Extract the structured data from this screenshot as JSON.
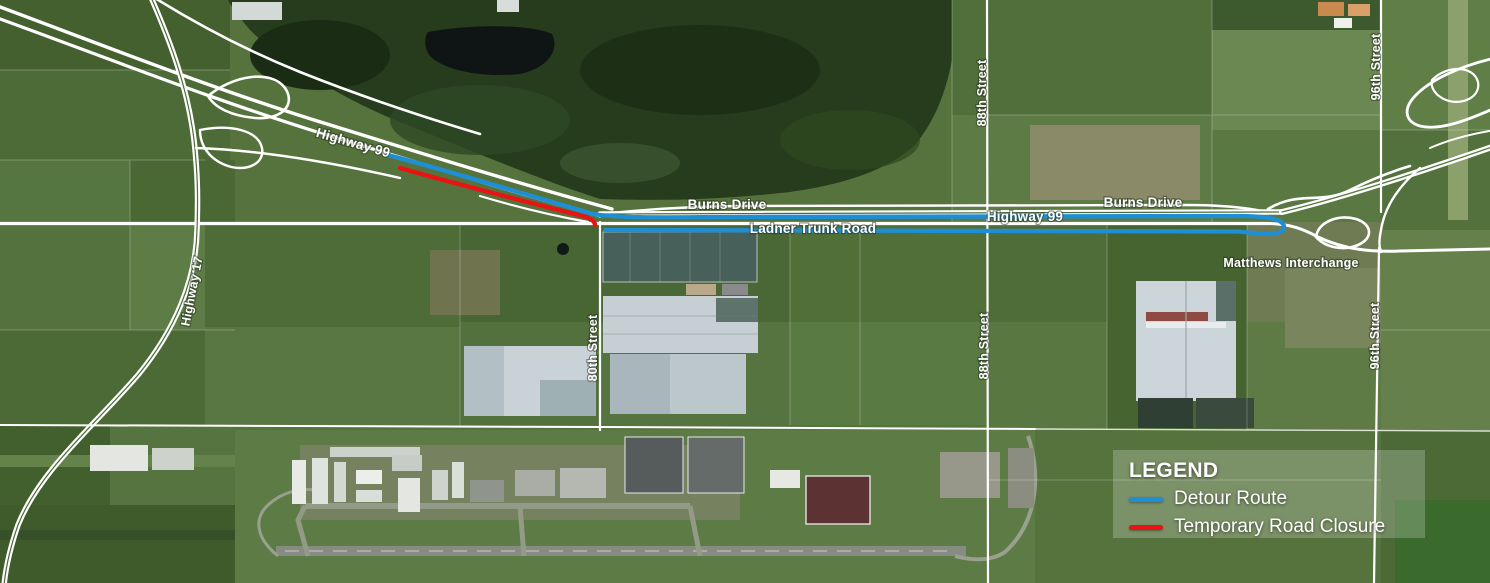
{
  "map": {
    "labels": {
      "highway99_left": "Highway 99",
      "highway17": "Highway 17",
      "burns_drive_left": "Burns Drive",
      "ladner_trunk_road": "Ladner Trunk Road",
      "highway99_right": "Highway 99",
      "burns_drive_right": "Burns Drive",
      "matthews_interchange": "Matthews Interchange",
      "street_80": "80th Street",
      "street_88_top": "88th Street",
      "street_88_bottom": "88th Street",
      "street_96_top": "96th Street",
      "street_96_bottom": "96th Street"
    },
    "colors": {
      "detour_route": "#1e8fd6",
      "road_closure": "#e81414",
      "road": "#ffffff"
    }
  },
  "legend": {
    "title": "LEGEND",
    "items": [
      {
        "label": "Detour Route",
        "color": "#1e8fd6"
      },
      {
        "label": "Temporary Road Closure",
        "color": "#e81414"
      }
    ]
  }
}
